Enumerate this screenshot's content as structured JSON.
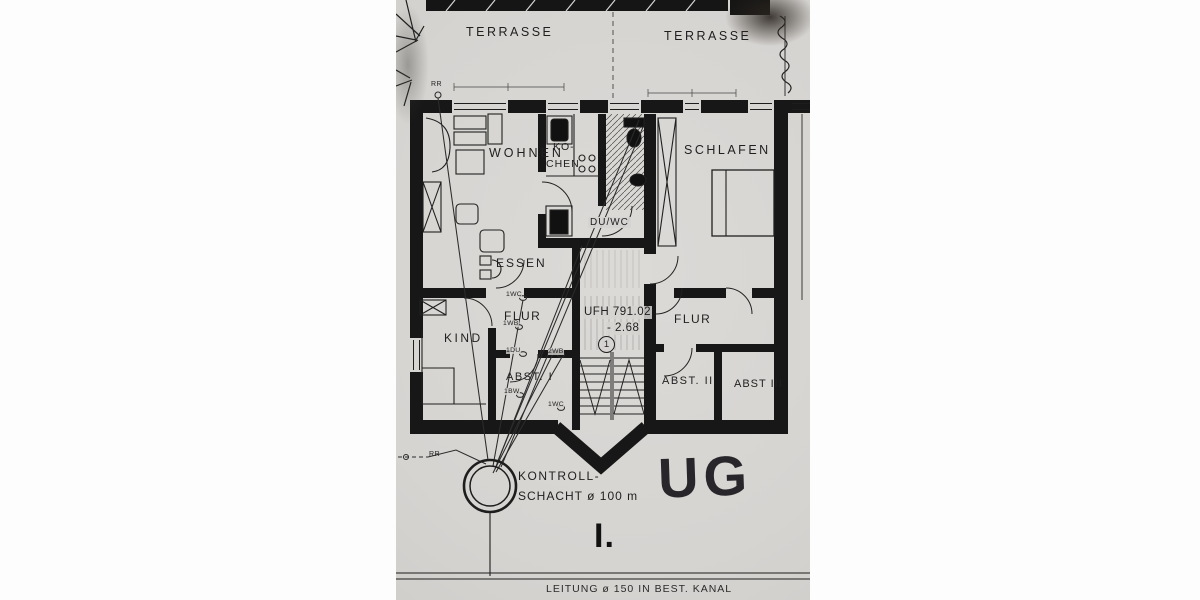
{
  "plan": {
    "rooms": {
      "terrasse_left": "TERRASSE",
      "terrasse_right": "TERRASSE",
      "wohnen": "WOHNEN",
      "kueche_line1": "KO-",
      "kueche_line2": "CHEN",
      "schlafen": "SCHLAFEN",
      "du_wc": "DU/WC",
      "essen": "ESSEN",
      "kind": "KIND",
      "flur_left": "FLUR",
      "flur_right": "FLUR",
      "abst_1": "ABST. I",
      "abst_2": "ABST. II",
      "abst_3": "ABST III"
    },
    "stair": {
      "ufh": "UFH 791.02",
      "depth": "- 2.68",
      "mark": "1"
    },
    "fixtures": {
      "wc_upper": "1WC",
      "wb_upper": "1WB",
      "du": "1DU",
      "wb_double": "2WB",
      "bw": "1BW",
      "wc_lower": "1WC",
      "rr_top": "RR",
      "rr_bottom": "RR"
    },
    "shaft": {
      "line1": "KONTROLL-",
      "line2": "SCHACHT ø 100 m"
    },
    "handwritten_floor": "UG",
    "sheet_mark": "I.",
    "footer_note": "LEITUNG ø 150 IN BEST. KANAL",
    "colors": {
      "paper": "#d8d6d3",
      "ink": "#1c1c1c",
      "page_bg": "#fdfdfd"
    }
  }
}
